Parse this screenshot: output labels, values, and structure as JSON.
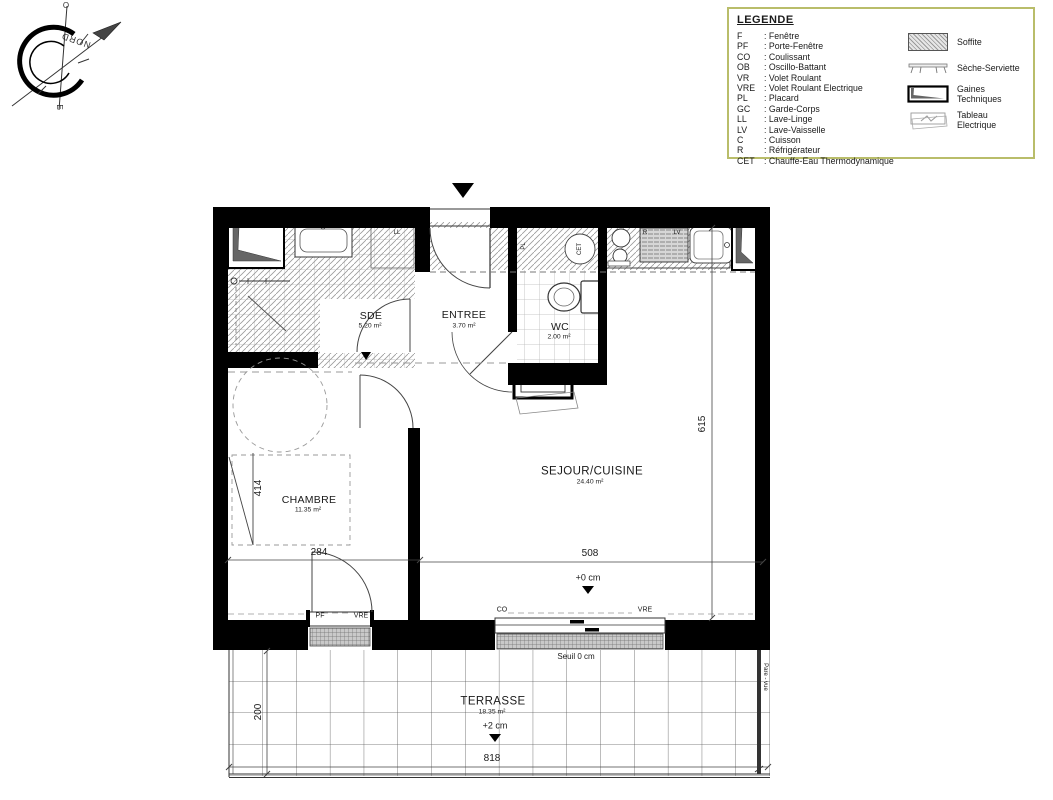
{
  "compass": {
    "north_label": "NORD",
    "letter_top": "O",
    "letter_bottom": "E"
  },
  "legend": {
    "title": "LEGENDE",
    "abbreviations": [
      {
        "abbr": "F",
        "label": "Fenêtre"
      },
      {
        "abbr": "PF",
        "label": "Porte-Fenêtre"
      },
      {
        "abbr": "CO",
        "label": "Coulissant"
      },
      {
        "abbr": "OB",
        "label": "Oscillo-Battant"
      },
      {
        "abbr": "VR",
        "label": "Volet Roulant"
      },
      {
        "abbr": "VRE",
        "label": "Volet Roulant Electrique"
      },
      {
        "abbr": "PL",
        "label": "Placard"
      },
      {
        "abbr": "GC",
        "label": "Garde-Corps"
      },
      {
        "abbr": "LL",
        "label": "Lave-Linge"
      },
      {
        "abbr": "LV",
        "label": "Lave-Vaisselle"
      },
      {
        "abbr": "C",
        "label": "Cuisson"
      },
      {
        "abbr": "R",
        "label": "Réfrigérateur"
      },
      {
        "abbr": "CET",
        "label": "Chauffe-Eau Thermodynamique"
      }
    ],
    "symbols": [
      {
        "name": "soffite-symbol",
        "label": "Soffite"
      },
      {
        "name": "seche-serviette-symbol",
        "label": "Sèche-Serviette"
      },
      {
        "name": "gaines-techniques-symbol",
        "label": "Gaines Techniques"
      },
      {
        "name": "tableau-electrique-symbol",
        "label": "Tableau Electrique"
      }
    ],
    "border_color": "#b9bd6a"
  },
  "plan": {
    "rooms": [
      {
        "id": "sde",
        "name": "SDE",
        "area": "5.20 m²"
      },
      {
        "id": "entree",
        "name": "ENTREE",
        "area": "3.70 m²"
      },
      {
        "id": "wc",
        "name": "WC",
        "area": "2.00 m²"
      },
      {
        "id": "sejour",
        "name": "SEJOUR/CUISINE",
        "area": "24.40 m²"
      },
      {
        "id": "chambre",
        "name": "CHAMBRE",
        "area": "11.35 m²"
      },
      {
        "id": "terrasse",
        "name": "TERRASSE",
        "area": "18.35 m²"
      }
    ],
    "dimensions": {
      "chambre_height": "414",
      "chambre_width": "284",
      "sejour_width": "508",
      "sejour_height": "615",
      "terrasse_depth": "200",
      "terrasse_width": "818"
    },
    "levels": {
      "sejour": "+0 cm",
      "terrasse": "+2 cm",
      "seuil": "Seuil 0 cm"
    },
    "openings": {
      "chambre_door": "PF",
      "chambre_shutter": "VRE",
      "sejour_door": "CO",
      "sejour_shutter": "VRE"
    },
    "labels": {
      "washer": "LL",
      "closet": "PL",
      "water_heater": "CET",
      "fridge": "R",
      "dishwasher": "LV",
      "privacy_screen": "Pare - vue"
    }
  }
}
